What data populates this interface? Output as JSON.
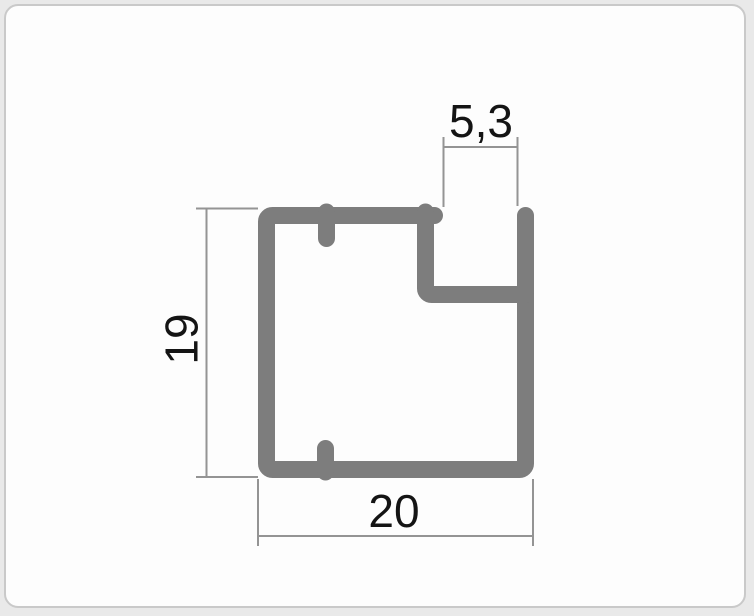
{
  "page": {
    "background_color": "#e9e9e9"
  },
  "card": {
    "background_color": "#fdfdfd",
    "border_color": "#c9c9c9"
  },
  "drawing": {
    "profile_color": "#7d7d7d",
    "dimension_line_color": "#949494",
    "label_color": "#141414",
    "dimensions": {
      "slot_width_label": "5,3",
      "profile_height_label": "19",
      "profile_width_label": "20"
    }
  }
}
